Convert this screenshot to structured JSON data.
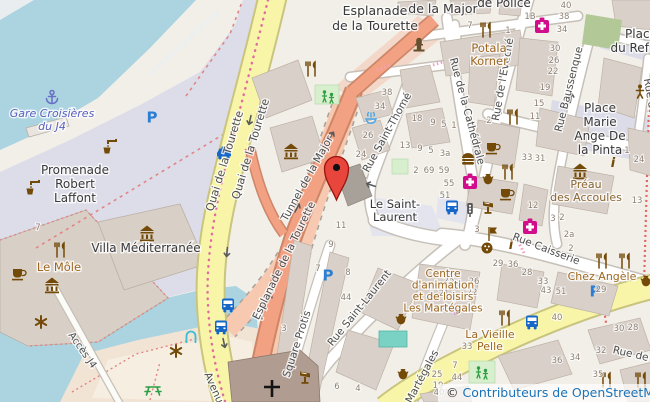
{
  "map": {
    "attribution": {
      "symbol": "©",
      "text": "Contributeurs de OpenStreetMap"
    },
    "colors": {
      "water": "#abd4e0",
      "land": "#f2efe9",
      "pedestrian": "#dddde9",
      "building": "#d9d0c9",
      "road_yellow": "#f8f5a9",
      "road_salmon": "#f3a183",
      "tunnel_salmon": "#f7c9b0",
      "accent_marker": "#e8453c",
      "parking_blue": "#2a7fd4",
      "transport_blue": "#1667c7",
      "health_pink": "#d10d8c",
      "poi_brown": "#734a08",
      "leisure_green": "#2f9e44",
      "label_dark": "#39383a",
      "label_food": "#9d6721",
      "label_street": "#4d4d4d",
      "label_ferry": "#5a60c0",
      "attribution_blue": "#1a73b9"
    },
    "marker": {
      "x": 336.5,
      "y": 200
    },
    "place_labels": [
      {
        "id": "gare-croisieres-du-j4",
        "lines": [
          "Gare Croisières",
          "du J4"
        ],
        "x": 52,
        "y": 117,
        "lh": 13,
        "c": "#5a60c0",
        "f": 11,
        "it": 1
      },
      {
        "id": "promenade-robert-laffont",
        "lines": [
          "Promenade",
          "Robert",
          "Laffont"
        ],
        "x": 75,
        "y": 174,
        "lh": 14,
        "c": "#39383a",
        "f": 12
      },
      {
        "id": "villa-mediterranee",
        "lines": [
          "Villa Méditerranée"
        ],
        "x": 146,
        "y": 252,
        "lh": 14,
        "c": "#39383a",
        "f": 12
      },
      {
        "id": "le-mole",
        "lines": [
          "Le Môle"
        ],
        "x": 59,
        "y": 271,
        "lh": 13,
        "c": "#9d6721",
        "f": 11.5
      },
      {
        "id": "esplanade-de-la-tourette",
        "lines": [
          "Esplanade",
          "de la Tourette"
        ],
        "x": 375,
        "y": 15,
        "lh": 15,
        "c": "#39383a",
        "f": 12.5
      },
      {
        "id": "de-la-major",
        "lines": [
          "de la Major"
        ],
        "x": 443,
        "y": 13,
        "lh": 14,
        "c": "#39383a",
        "f": 12.5
      },
      {
        "id": "de-police",
        "lines": [
          "de Police"
        ],
        "x": 504,
        "y": 7,
        "lh": 14,
        "c": "#39383a",
        "f": 12
      },
      {
        "id": "potala-korner",
        "lines": [
          "Potala",
          "Korner"
        ],
        "x": 489,
        "y": 52,
        "lh": 13,
        "c": "#9d6721",
        "f": 11.5
      },
      {
        "id": "place-du-refuge",
        "lines": [
          "Place",
          "du Refuge"
        ],
        "x": 641,
        "y": 38,
        "lh": 14,
        "c": "#39383a",
        "f": 12
      },
      {
        "id": "place-marie-ange-de-la-pinta",
        "lines": [
          "Place",
          "Marie",
          "Ange De",
          "la Pinta"
        ],
        "x": 600,
        "y": 112,
        "lh": 14,
        "c": "#39383a",
        "f": 12
      },
      {
        "id": "preau-des-accoules",
        "lines": [
          "Préau",
          "des Accoules"
        ],
        "x": 586,
        "y": 188,
        "lh": 13,
        "c": "#8a6531",
        "f": 11
      },
      {
        "id": "le-saint-laurent",
        "lines": [
          "Le Saint-",
          "Laurent"
        ],
        "x": 395,
        "y": 208,
        "lh": 13,
        "c": "#39383a",
        "f": 11.5
      },
      {
        "id": "centre-les-martegales",
        "lines": [
          "Centre",
          "d'animation",
          "et de loisirs",
          "Les Martégales"
        ],
        "x": 443,
        "y": 277,
        "lh": 11.5,
        "c": "#9d6721",
        "f": 10.5
      },
      {
        "id": "la-vieille-pelle",
        "lines": [
          "La Vieille",
          "Pelle"
        ],
        "x": 490,
        "y": 338,
        "lh": 12,
        "c": "#9d6721",
        "f": 11
      },
      {
        "id": "chez-angele",
        "lines": [
          "Chez Angèle"
        ],
        "x": 602,
        "y": 280,
        "lh": 12,
        "c": "#9d6721",
        "f": 11
      }
    ],
    "street_labels": [
      {
        "t": "Quai de la Tourette",
        "x": 228,
        "y": 162,
        "r": -73,
        "fs": 11
      },
      {
        "t": "Quai de la Tourette",
        "x": 254,
        "y": 150,
        "r": -73,
        "fs": 11
      },
      {
        "t": "Tunnel de la Major",
        "x": 310,
        "y": 180,
        "r": -61,
        "fs": 10.5
      },
      {
        "t": "Esplanade de la Tourette",
        "x": 287,
        "y": 262,
        "r": -64,
        "fs": 10.5
      },
      {
        "t": "Rue Saint-Thomé",
        "x": 390,
        "y": 134,
        "r": -61,
        "fs": 10.5
      },
      {
        "t": "Rue de la Cathédrale",
        "x": 464,
        "y": 112,
        "r": 75,
        "fs": 10.5
      },
      {
        "t": "Rue de l'Evêché",
        "x": 506,
        "y": 80,
        "r": -80,
        "fs": 10.5
      },
      {
        "t": "Rue Baussenque",
        "x": 572,
        "y": 90,
        "r": -76,
        "fs": 10.5
      },
      {
        "t": "Rue Caisserie",
        "x": 545,
        "y": 252,
        "r": 21,
        "fs": 10.5
      },
      {
        "t": "Rue Saint-Laurent",
        "x": 362,
        "y": 310,
        "r": -51,
        "fs": 10.5
      },
      {
        "t": "Square Protis",
        "x": 300,
        "y": 345,
        "r": -72,
        "fs": 10.5
      },
      {
        "t": "Martégales",
        "x": 425,
        "y": 378,
        "r": -62,
        "fs": 10.5
      },
      {
        "t": "Accès J4",
        "x": 80,
        "y": 352,
        "r": 55,
        "fs": 10
      },
      {
        "t": "Avenue",
        "x": 212,
        "y": 392,
        "r": 66,
        "fs": 10.5
      },
      {
        "t": "Rue de",
        "x": 630,
        "y": 357,
        "r": 13,
        "fs": 10.5
      },
      {
        "t": "Rue du",
        "x": 647,
        "y": 97,
        "r": 80,
        "fs": 10.5
      }
    ],
    "house_numbers": [
      {
        "t": "38",
        "x": 387,
        "y": 95
      },
      {
        "t": "34",
        "x": 380,
        "y": 109
      },
      {
        "t": "26",
        "x": 368,
        "y": 138
      },
      {
        "t": "24",
        "x": 361,
        "y": 157
      },
      {
        "t": "18",
        "x": 417,
        "y": 121
      },
      {
        "t": "9",
        "x": 433,
        "y": 125
      },
      {
        "t": "5",
        "x": 444,
        "y": 127
      },
      {
        "t": "1",
        "x": 454,
        "y": 128
      },
      {
        "t": "13",
        "x": 405,
        "y": 148
      },
      {
        "t": "9",
        "x": 420,
        "y": 151
      },
      {
        "t": "5",
        "x": 431,
        "y": 153
      },
      {
        "t": "3a",
        "x": 445,
        "y": 156
      },
      {
        "t": "2",
        "x": 416,
        "y": 173
      },
      {
        "t": "69",
        "x": 429,
        "y": 173
      },
      {
        "t": "59",
        "x": 444,
        "y": 173
      },
      {
        "t": "55",
        "x": 449,
        "y": 186
      },
      {
        "t": "51",
        "x": 445,
        "y": 198
      },
      {
        "t": "11",
        "x": 341,
        "y": 228
      },
      {
        "t": "9",
        "x": 331,
        "y": 247
      },
      {
        "t": "7",
        "x": 318,
        "y": 271
      },
      {
        "t": "8",
        "x": 348,
        "y": 275
      },
      {
        "t": "5",
        "x": 272,
        "y": 293
      },
      {
        "t": "4",
        "x": 261,
        "y": 320
      },
      {
        "t": "3",
        "x": 284,
        "y": 331
      },
      {
        "t": "44",
        "x": 346,
        "y": 300
      },
      {
        "t": "6",
        "x": 337,
        "y": 389
      },
      {
        "t": "4",
        "x": 358,
        "y": 391
      },
      {
        "t": "7",
        "x": 470,
        "y": 28
      },
      {
        "t": "1",
        "x": 508,
        "y": 33
      },
      {
        "t": "1B",
        "x": 530,
        "y": 19
      },
      {
        "t": "40",
        "x": 566,
        "y": 8
      },
      {
        "t": "38",
        "x": 564,
        "y": 19
      },
      {
        "t": "34",
        "x": 562,
        "y": 32
      },
      {
        "t": "30",
        "x": 555,
        "y": 51
      },
      {
        "t": "26",
        "x": 554,
        "y": 63
      },
      {
        "t": "22",
        "x": 553,
        "y": 74
      },
      {
        "t": "19",
        "x": 545,
        "y": 90
      },
      {
        "t": "15",
        "x": 539,
        "y": 106
      },
      {
        "t": "11",
        "x": 535,
        "y": 119
      },
      {
        "t": "3",
        "x": 500,
        "y": 115
      },
      {
        "t": "2",
        "x": 489,
        "y": 123
      },
      {
        "t": "33",
        "x": 527,
        "y": 160
      },
      {
        "t": "31",
        "x": 540,
        "y": 161
      },
      {
        "t": "1",
        "x": 627,
        "y": 153
      },
      {
        "t": "24",
        "x": 639,
        "y": 162
      },
      {
        "t": "12",
        "x": 533,
        "y": 208
      },
      {
        "t": "3",
        "x": 553,
        "y": 221
      },
      {
        "t": "2",
        "x": 562,
        "y": 220
      },
      {
        "t": "2a",
        "x": 569,
        "y": 237
      },
      {
        "t": "2",
        "x": 571,
        "y": 251
      },
      {
        "t": "13",
        "x": 637,
        "y": 203
      },
      {
        "t": "3",
        "x": 477,
        "y": 232
      },
      {
        "t": "29",
        "x": 498,
        "y": 266
      },
      {
        "t": "36",
        "x": 513,
        "y": 267
      },
      {
        "t": "28",
        "x": 527,
        "y": 275
      },
      {
        "t": "25",
        "x": 449,
        "y": 283
      },
      {
        "t": "21",
        "x": 444,
        "y": 296
      },
      {
        "t": "17",
        "x": 440,
        "y": 312
      },
      {
        "t": "26",
        "x": 474,
        "y": 284
      },
      {
        "t": "22",
        "x": 472,
        "y": 295
      },
      {
        "t": "14",
        "x": 469,
        "y": 312
      },
      {
        "t": "33",
        "x": 543,
        "y": 284
      },
      {
        "t": "43",
        "x": 546,
        "y": 293
      },
      {
        "t": "51",
        "x": 561,
        "y": 294
      },
      {
        "t": "29",
        "x": 601,
        "y": 292
      },
      {
        "t": "40",
        "x": 557,
        "y": 320
      },
      {
        "t": "33",
        "x": 467,
        "y": 349
      },
      {
        "t": "36",
        "x": 557,
        "y": 363
      },
      {
        "t": "34",
        "x": 575,
        "y": 360
      },
      {
        "t": "32",
        "x": 601,
        "y": 353
      },
      {
        "t": "35",
        "x": 598,
        "y": 377
      },
      {
        "t": "44",
        "x": 457,
        "y": 380
      },
      {
        "t": "7",
        "x": 455,
        "y": 368
      },
      {
        "t": "30",
        "x": 619,
        "y": 331
      },
      {
        "t": "28",
        "x": 633,
        "y": 330
      },
      {
        "t": "25",
        "x": 437,
        "y": 377
      },
      {
        "t": "19",
        "x": 438,
        "y": 388
      },
      {
        "t": "40",
        "x": 439,
        "y": 395
      },
      {
        "t": "7",
        "x": 38,
        "y": 230
      }
    ],
    "pois": [
      {
        "n": "anchor",
        "s": "anchor",
        "c": "#6670c4",
        "x": 52,
        "y": 97
      },
      {
        "n": "parking",
        "s": "parking",
        "c": "#2a7fd4",
        "x": 152,
        "y": 117
      },
      {
        "n": "parking",
        "s": "parking",
        "c": "#2a7fd4",
        "x": 328,
        "y": 275
      },
      {
        "n": "parking",
        "s": "parking",
        "c": "#2a7fd4",
        "x": 595,
        "y": 291
      },
      {
        "n": "taxi",
        "s": "taxi",
        "c": "#1667c7",
        "x": 224,
        "y": 153
      },
      {
        "n": "bus",
        "s": "bus",
        "c": "#1667c7",
        "x": 228,
        "y": 305
      },
      {
        "n": "bus",
        "s": "bus",
        "c": "#1667c7",
        "x": 221,
        "y": 327
      },
      {
        "n": "bus-stop",
        "s": "bus",
        "c": "#1667c7",
        "x": 452,
        "y": 207
      },
      {
        "n": "bus-stop",
        "s": "bus",
        "c": "#1667c7",
        "x": 532,
        "y": 322
      },
      {
        "n": "museum",
        "s": "museum",
        "c": "#734a08",
        "x": 291,
        "y": 151
      },
      {
        "n": "museum",
        "s": "museum",
        "c": "#734a08",
        "x": 147,
        "y": 233
      },
      {
        "n": "museum",
        "s": "museum",
        "c": "#734a08",
        "x": 52,
        "y": 285
      },
      {
        "n": "museum",
        "s": "museum",
        "c": "#734a08",
        "x": 580,
        "y": 171
      },
      {
        "n": "monument",
        "s": "monument",
        "c": "#64502e",
        "x": 419,
        "y": 45
      },
      {
        "n": "restaurant",
        "s": "restaurant",
        "c": "#734a08",
        "x": 311,
        "y": 69
      },
      {
        "n": "restaurant",
        "s": "restaurant",
        "c": "#734a08",
        "x": 486,
        "y": 30
      },
      {
        "n": "restaurant",
        "s": "restaurant",
        "c": "#734a08",
        "x": 513,
        "y": 117
      },
      {
        "n": "restaurant",
        "s": "restaurant",
        "c": "#734a08",
        "x": 505,
        "y": 318
      },
      {
        "n": "restaurant",
        "s": "restaurant",
        "c": "#734a08",
        "x": 602,
        "y": 261
      },
      {
        "n": "restaurant",
        "s": "restaurant",
        "c": "#734a08",
        "x": 625,
        "y": 261
      },
      {
        "n": "restaurant",
        "s": "restaurant",
        "c": "#734a08",
        "x": 60,
        "y": 250
      },
      {
        "n": "restaurant",
        "s": "restaurant",
        "c": "#734a08",
        "x": 508,
        "y": 172
      },
      {
        "n": "restaurant",
        "s": "restaurant",
        "c": "#734a08",
        "x": 606,
        "y": 380
      },
      {
        "n": "restaurant",
        "s": "restaurant",
        "c": "#734a08",
        "x": 641,
        "y": 380
      },
      {
        "n": "cafe",
        "s": "cafe",
        "c": "#734a08",
        "x": 19,
        "y": 273
      },
      {
        "n": "cafe",
        "s": "cafe",
        "c": "#734a08",
        "x": 493,
        "y": 147
      },
      {
        "n": "cafe",
        "s": "cafe",
        "c": "#734a08",
        "x": 507,
        "y": 193
      },
      {
        "n": "fast-food",
        "s": "fastfood",
        "c": "#734a08",
        "x": 468,
        "y": 159
      },
      {
        "n": "pharmacy",
        "s": "pharmacy",
        "c": "#d10d8c",
        "x": 542,
        "y": 26
      },
      {
        "n": "pharmacy",
        "s": "pharmacy",
        "c": "#d10d8c",
        "x": 470,
        "y": 182
      },
      {
        "n": "pharmacy",
        "s": "pharmacy",
        "c": "#d10d8c",
        "x": 530,
        "y": 227
      },
      {
        "n": "drinking-water",
        "s": "water",
        "c": "#734a08",
        "x": 110,
        "y": 146
      },
      {
        "n": "drinking-water",
        "s": "water",
        "c": "#734a08",
        "x": 33,
        "y": 187
      },
      {
        "n": "playground",
        "s": "playground",
        "c": "#2f9e44",
        "x": 328,
        "y": 96
      },
      {
        "n": "playground",
        "s": "playground",
        "c": "#2f9e44",
        "x": 482,
        "y": 372
      },
      {
        "n": "fountain",
        "s": "fountain",
        "c": "#4aa5e8",
        "x": 371,
        "y": 119
      },
      {
        "n": "artwork",
        "s": "artwork",
        "c": "#734a08",
        "x": 41,
        "y": 322
      },
      {
        "n": "artwork",
        "s": "artwork",
        "c": "#734a08",
        "x": 176,
        "y": 351
      },
      {
        "n": "picnic-table",
        "s": "picnic",
        "c": "#2f9e44",
        "x": 153,
        "y": 389
      },
      {
        "n": "gate-arch",
        "s": "arch",
        "c": "#3bbdd4",
        "x": 191,
        "y": 337
      },
      {
        "n": "information",
        "s": "info",
        "c": "#734a08",
        "x": 511,
        "y": 244
      },
      {
        "n": "information",
        "s": "info",
        "c": "#734a08",
        "x": 613,
        "y": 162
      },
      {
        "n": "lectern",
        "s": "lectern",
        "c": "#734a08",
        "x": 488,
        "y": 207
      },
      {
        "n": "lectern",
        "s": "lectern",
        "c": "#734a08",
        "x": 305,
        "y": 377
      },
      {
        "n": "artefact-vase",
        "s": "vase",
        "c": "#734a08",
        "x": 488,
        "y": 181
      },
      {
        "n": "artefact-vase",
        "s": "vase",
        "c": "#734a08",
        "x": 401,
        "y": 321
      },
      {
        "n": "artefact-vase",
        "s": "vase",
        "c": "#734a08",
        "x": 403,
        "y": 376
      },
      {
        "n": "artefact-vase",
        "s": "vase",
        "c": "#734a08",
        "x": 646,
        "y": 283
      },
      {
        "n": "traffic-light",
        "s": "tlight",
        "c": "#555555",
        "x": 470,
        "y": 210
      },
      {
        "n": "person",
        "s": "person",
        "c": "#734a08",
        "x": 640,
        "y": 91
      },
      {
        "n": "flag",
        "s": "flag",
        "c": "#734a08",
        "x": 492,
        "y": 234
      },
      {
        "n": "art-palette",
        "s": "palette",
        "c": "#734a08",
        "x": 487,
        "y": 248
      }
    ],
    "arrows": [
      {
        "x": 250,
        "y": 120,
        "r": 103
      },
      {
        "x": 227,
        "y": 252,
        "r": 95
      },
      {
        "x": 224,
        "y": 343,
        "r": 78
      },
      {
        "x": 331,
        "y": 136,
        "r": -57
      },
      {
        "x": 297,
        "y": 208,
        "r": -62
      },
      {
        "x": 269,
        "y": 298,
        "r": -66
      },
      {
        "x": 371,
        "y": 185,
        "r": 198
      },
      {
        "x": 571,
        "y": 98,
        "r": -80
      }
    ]
  }
}
